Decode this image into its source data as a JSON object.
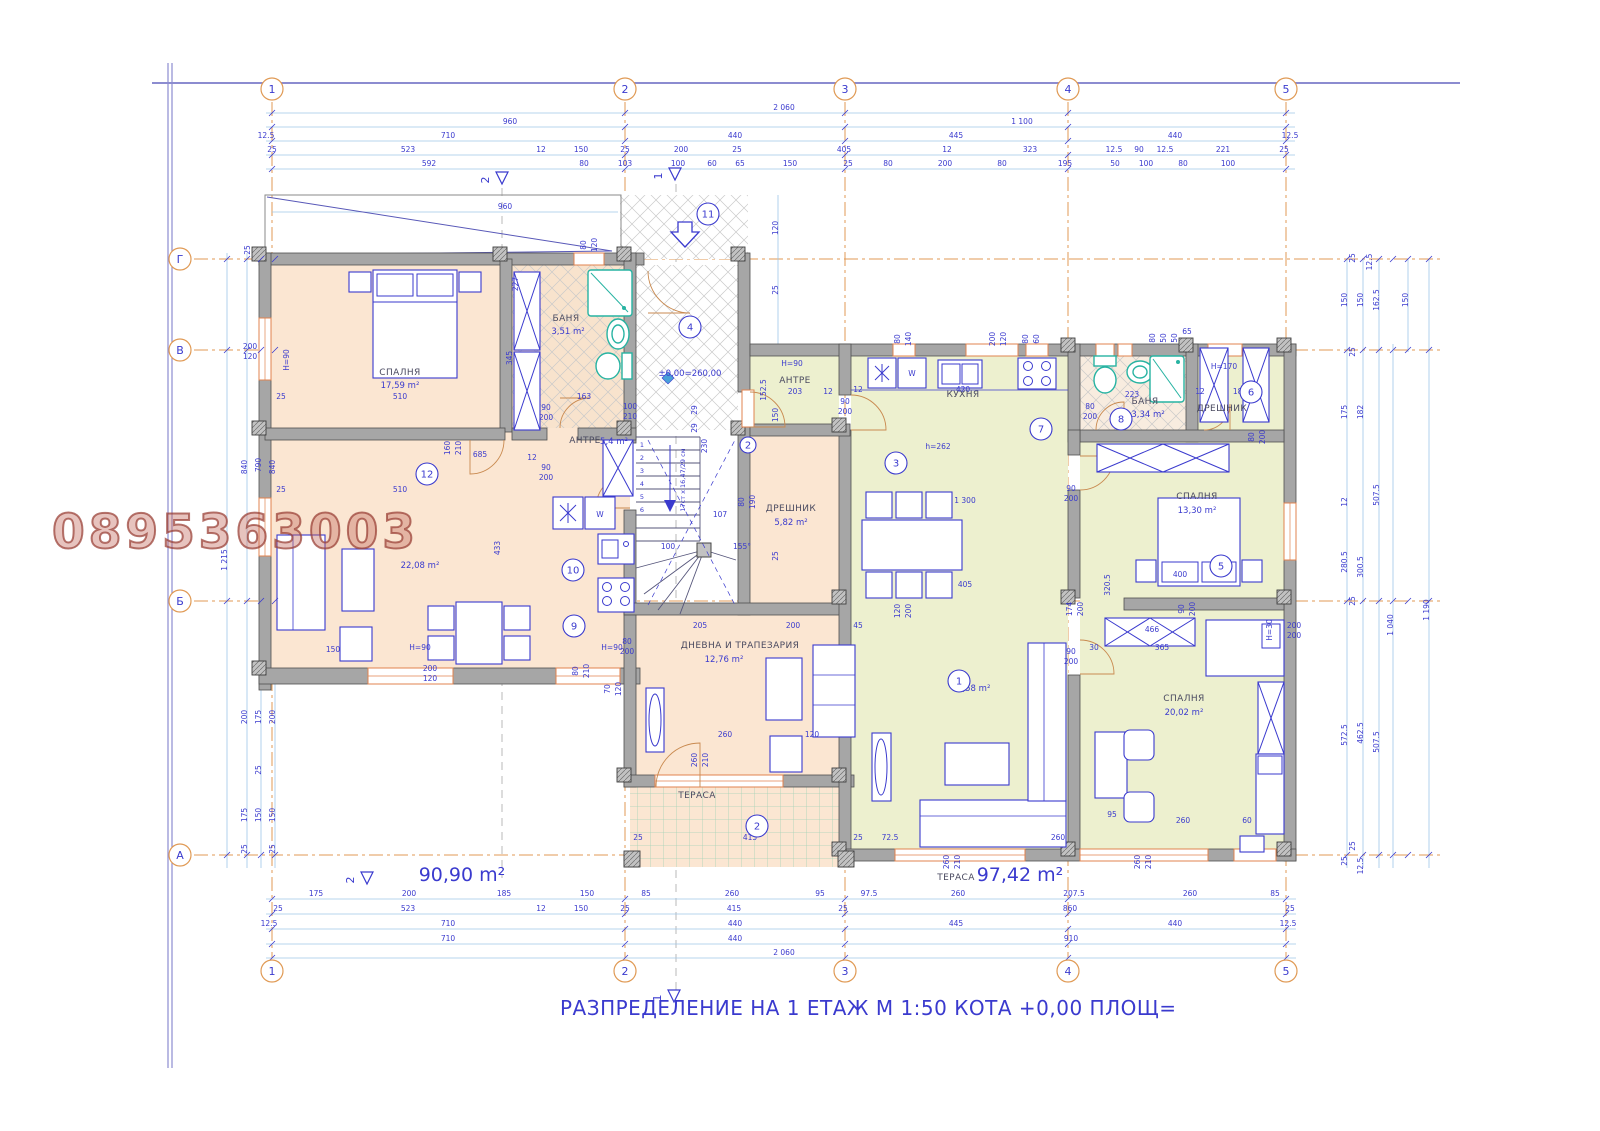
{
  "title": "РАЗПРЕДЕЛЕНИЕ НА 1 ЕТАЖ  М 1:50  КОТА +0,00  ПЛОЩ=",
  "watermark": "0895363003",
  "footer": {
    "left_area": "90,90 m²",
    "right_terrace_label": "ТЕРАСА",
    "right_area": "97,42 m²"
  },
  "level_mark": "±0,00=260,00",
  "stairs_note": "17ст x 16,47/29 см",
  "grid": {
    "cols": [
      "1",
      "2",
      "3",
      "4",
      "5"
    ],
    "col_x": [
      272,
      625,
      845,
      1068,
      1286
    ],
    "rows": [
      "Г",
      "В",
      "Б",
      "А"
    ],
    "row_y": [
      259,
      350,
      601,
      855
    ]
  },
  "rooms": [
    {
      "name": "СПАЛНЯ",
      "area": "17,59 m²"
    },
    {
      "name": "БАНЯ",
      "area": "3,51 m²"
    },
    {
      "name": "АНТРЕ",
      "area": "5,4 m²"
    },
    {
      "name": "",
      "area": "22,08 m²"
    },
    {
      "name": "ДНЕВНА И ТРАПЕЗАРИЯ",
      "area": "12,76 m²"
    },
    {
      "name": "ДРЕШНИК",
      "area": "5,82 m²"
    },
    {
      "name": "ТЕРАСА",
      "area": ""
    },
    {
      "name": "АНТРЕ",
      "area": ""
    },
    {
      "name": "КУХНЯ",
      "area": ""
    },
    {
      "name": "БАНЯ",
      "area": "3,34 m²"
    },
    {
      "name": "ДРЕШНИК",
      "area": ""
    },
    {
      "name": "СПАЛНЯ",
      "area": "13,30 m²"
    },
    {
      "name": "СПАЛНЯ",
      "area": "20,02 m²"
    },
    {
      "name": "",
      "area": "41,58 m²"
    },
    {
      "name": "ТЕРАСА",
      "area": "97,42 m²"
    }
  ],
  "room_tags": [
    {
      "n": "11",
      "x": 708,
      "y": 214
    },
    {
      "n": "4",
      "x": 690,
      "y": 327
    },
    {
      "n": "2",
      "x": 748,
      "y": 445,
      "s": 1
    },
    {
      "n": "12",
      "x": 427,
      "y": 474
    },
    {
      "n": "10",
      "x": 573,
      "y": 570
    },
    {
      "n": "9",
      "x": 574,
      "y": 626
    },
    {
      "n": "3",
      "x": 896,
      "y": 463
    },
    {
      "n": "7",
      "x": 1041,
      "y": 429
    },
    {
      "n": "8",
      "x": 1121,
      "y": 419
    },
    {
      "n": "6",
      "x": 1251,
      "y": 392
    },
    {
      "n": "5",
      "x": 1221,
      "y": 566
    },
    {
      "n": "1",
      "x": 959,
      "y": 681
    },
    {
      "n": "2",
      "x": 757,
      "y": 826
    }
  ],
  "section_markers": [
    {
      "n": "2",
      "x": 502,
      "y": 180
    },
    {
      "n": "1",
      "x": 675,
      "y": 176
    },
    {
      "n": "2",
      "x": 367,
      "y": 880
    },
    {
      "n": "1",
      "x": 674,
      "y": 998
    }
  ],
  "stair_steps": [
    "1",
    "2",
    "3",
    "4",
    "5",
    "6"
  ],
  "colors": {
    "peach": "#fbe6d2",
    "green": "#edf0cf",
    "wall": "#a6a6a6",
    "blue": "#3a3ace",
    "dim_line": "#9fc6e8",
    "axis_orange": "#e09a55",
    "teal": "#27b3a2",
    "watermark": "#a85648"
  },
  "dim_labels": [
    [
      "2 060",
      784,
      110
    ],
    [
      "960",
      510,
      124
    ],
    [
      "1 100",
      1022,
      124
    ],
    [
      "12.5",
      266,
      138
    ],
    [
      "710",
      448,
      138
    ],
    [
      "440",
      735,
      138
    ],
    [
      "445",
      956,
      138
    ],
    [
      "440",
      1175,
      138
    ],
    [
      "12.5",
      1290,
      138
    ],
    [
      "25",
      272,
      152
    ],
    [
      "523",
      408,
      152
    ],
    [
      "12",
      541,
      152
    ],
    [
      "150",
      581,
      152
    ],
    [
      "25",
      625,
      152
    ],
    [
      "200",
      681,
      152
    ],
    [
      "25",
      737,
      152
    ],
    [
      "405",
      844,
      152
    ],
    [
      "12",
      947,
      152
    ],
    [
      "323",
      1030,
      152
    ],
    [
      "12.5",
      1114,
      152
    ],
    [
      "90",
      1139,
      152
    ],
    [
      "12.5",
      1165,
      152
    ],
    [
      "221",
      1223,
      152
    ],
    [
      "25",
      1284,
      152
    ],
    [
      "592",
      429,
      166
    ],
    [
      "80",
      584,
      166
    ],
    [
      "103",
      625,
      166
    ],
    [
      "100",
      678,
      166
    ],
    [
      "60",
      712,
      166
    ],
    [
      "65",
      740,
      166
    ],
    [
      "150",
      790,
      166
    ],
    [
      "25",
      848,
      166
    ],
    [
      "80",
      888,
      166
    ],
    [
      "200",
      945,
      166
    ],
    [
      "80",
      1002,
      166
    ],
    [
      "195",
      1065,
      166
    ],
    [
      "50",
      1115,
      166
    ],
    [
      "100",
      1146,
      166
    ],
    [
      "80",
      1183,
      166
    ],
    [
      "100",
      1228,
      166
    ],
    [
      "175",
      316,
      896
    ],
    [
      "200",
      409,
      896
    ],
    [
      "185",
      504,
      896
    ],
    [
      "150",
      587,
      896
    ],
    [
      "85",
      646,
      896
    ],
    [
      "260",
      732,
      896
    ],
    [
      "95",
      820,
      896
    ],
    [
      "97.5",
      869,
      896
    ],
    [
      "260",
      958,
      896
    ],
    [
      "207.5",
      1074,
      896
    ],
    [
      "260",
      1190,
      896
    ],
    [
      "85",
      1275,
      896
    ],
    [
      "25",
      278,
      911
    ],
    [
      "523",
      408,
      911
    ],
    [
      "12",
      541,
      911
    ],
    [
      "150",
      581,
      911
    ],
    [
      "25",
      625,
      911
    ],
    [
      "415",
      734,
      911
    ],
    [
      "25",
      843,
      911
    ],
    [
      "860",
      1070,
      911
    ],
    [
      "25",
      1290,
      911
    ],
    [
      "12.5",
      269,
      926
    ],
    [
      "710",
      448,
      926
    ],
    [
      "440",
      735,
      926
    ],
    [
      "445",
      956,
      926
    ],
    [
      "440",
      1175,
      926
    ],
    [
      "12.5",
      1288,
      926
    ],
    [
      "710",
      448,
      941
    ],
    [
      "440",
      735,
      941
    ],
    [
      "910",
      1071,
      941
    ],
    [
      "2 060",
      784,
      955
    ],
    [
      "25",
      250,
      250,
      1
    ],
    [
      "840",
      247,
      467,
      1
    ],
    [
      "790",
      261,
      465,
      1
    ],
    [
      "840",
      275,
      467,
      1
    ],
    [
      "1 215",
      227,
      560,
      1
    ],
    [
      "200",
      247,
      717,
      1
    ],
    [
      "175",
      261,
      717,
      1
    ],
    [
      "200",
      275,
      717,
      1
    ],
    [
      "25",
      261,
      770,
      1
    ],
    [
      "175",
      247,
      815,
      1
    ],
    [
      "150",
      261,
      815,
      1
    ],
    [
      "150",
      275,
      815,
      1
    ],
    [
      "25",
      247,
      849,
      1
    ],
    [
      "25",
      275,
      849,
      1
    ],
    [
      "200",
      250,
      349
    ],
    [
      "120",
      250,
      359
    ],
    [
      "H=90",
      289,
      360,
      1
    ],
    [
      "25",
      1355,
      258,
      1
    ],
    [
      "12.5",
      1372,
      262,
      1
    ],
    [
      "150",
      1347,
      300,
      1
    ],
    [
      "150",
      1363,
      300,
      1
    ],
    [
      "162.5",
      1379,
      300,
      1
    ],
    [
      "150",
      1408,
      300,
      1
    ],
    [
      "25",
      1355,
      352,
      1
    ],
    [
      "175",
      1347,
      412,
      1
    ],
    [
      "182",
      1363,
      412,
      1
    ],
    [
      "12",
      1347,
      502,
      1
    ],
    [
      "507.5",
      1379,
      495,
      1
    ],
    [
      "280.5",
      1347,
      562,
      1
    ],
    [
      "300.5",
      1363,
      567,
      1
    ],
    [
      "25",
      1355,
      601,
      1
    ],
    [
      "1 190",
      1429,
      610,
      1
    ],
    [
      "1 040",
      1393,
      625,
      1
    ],
    [
      "572.5",
      1347,
      735,
      1
    ],
    [
      "462.5",
      1363,
      733,
      1
    ],
    [
      "507.5",
      1379,
      742,
      1
    ],
    [
      "25",
      1355,
      846,
      1
    ],
    [
      "25",
      1347,
      861,
      1
    ],
    [
      "12.5",
      1363,
      866,
      1
    ],
    [
      "120",
      778,
      228,
      1
    ],
    [
      "25",
      778,
      290,
      1
    ],
    [
      "150",
      778,
      415,
      1
    ],
    [
      "25",
      778,
      556,
      1
    ],
    [
      "960",
      505,
      209
    ],
    [
      "345",
      512,
      358,
      1
    ],
    [
      "227",
      518,
      284,
      1
    ],
    [
      "510",
      400,
      399
    ],
    [
      "25",
      281,
      399
    ],
    [
      "160",
      450,
      448,
      1
    ],
    [
      "210",
      461,
      448,
      1
    ],
    [
      "685",
      480,
      457
    ],
    [
      "12",
      532,
      460
    ],
    [
      "510",
      400,
      492
    ],
    [
      "25",
      281,
      492
    ],
    [
      "90",
      546,
      410
    ],
    [
      "200",
      546,
      420
    ],
    [
      "90",
      546,
      470
    ],
    [
      "200",
      546,
      480
    ],
    [
      "163",
      584,
      399
    ],
    [
      "100",
      630,
      409
    ],
    [
      "210",
      630,
      419
    ],
    [
      "80",
      586,
      245,
      1
    ],
    [
      "120",
      597,
      245,
      1
    ],
    [
      "433",
      500,
      548,
      1
    ],
    [
      "150",
      333,
      652
    ],
    [
      "H=90",
      420,
      650
    ],
    [
      "200",
      430,
      671
    ],
    [
      "120",
      430,
      681
    ],
    [
      "H=90",
      612,
      650
    ],
    [
      "80",
      578,
      671,
      1
    ],
    [
      "210",
      589,
      671,
      1
    ],
    [
      "70",
      610,
      689,
      1
    ],
    [
      "120",
      621,
      689,
      1
    ],
    [
      "W",
      600,
      517
    ],
    [
      "W",
      912,
      376
    ],
    [
      "230",
      707,
      446,
      1
    ],
    [
      "29",
      697,
      410,
      1
    ],
    [
      "29",
      697,
      428,
      1
    ],
    [
      "100",
      668,
      549
    ],
    [
      "107",
      720,
      517
    ],
    [
      "155°",
      742,
      549
    ],
    [
      "80",
      744,
      502,
      1
    ],
    [
      "190",
      755,
      502,
      1
    ],
    [
      "205",
      700,
      628
    ],
    [
      "200",
      793,
      628
    ],
    [
      "45",
      858,
      628
    ],
    [
      "80",
      627,
      644
    ],
    [
      "200",
      627,
      654
    ],
    [
      "260",
      725,
      737
    ],
    [
      "120",
      812,
      737
    ],
    [
      "260",
      697,
      760,
      1
    ],
    [
      "210",
      708,
      760,
      1
    ],
    [
      "25",
      638,
      840
    ],
    [
      "415",
      750,
      840
    ],
    [
      "25",
      858,
      840
    ],
    [
      "72.5",
      890,
      840
    ],
    [
      "260",
      1058,
      840
    ],
    [
      "H=90",
      792,
      366
    ],
    [
      "203",
      795,
      394
    ],
    [
      "152.5",
      766,
      390,
      1
    ],
    [
      "12",
      828,
      394
    ],
    [
      "90",
      845,
      404
    ],
    [
      "200",
      845,
      414
    ],
    [
      "80",
      900,
      339,
      1
    ],
    [
      "140",
      911,
      339,
      1
    ],
    [
      "200",
      995,
      339,
      1
    ],
    [
      "120",
      1006,
      339,
      1
    ],
    [
      "80",
      1028,
      339,
      1
    ],
    [
      "60",
      1039,
      339,
      1
    ],
    [
      "12",
      858,
      392
    ],
    [
      "420",
      963,
      392
    ],
    [
      "h=262",
      938,
      449
    ],
    [
      "80",
      1090,
      409
    ],
    [
      "200",
      1090,
      419
    ],
    [
      "223",
      1132,
      397
    ],
    [
      "80",
      1155,
      338,
      1
    ],
    [
      "50",
      1166,
      338,
      1
    ],
    [
      "50",
      1177,
      338,
      1
    ],
    [
      "65",
      1187,
      334
    ],
    [
      "12",
      1200,
      394
    ],
    [
      "180",
      1240,
      394
    ],
    [
      "150",
      1254,
      387,
      1
    ],
    [
      "H=170",
      1224,
      369
    ],
    [
      "80",
      1254,
      437,
      1
    ],
    [
      "200",
      1265,
      437,
      1
    ],
    [
      "90",
      1071,
      491
    ],
    [
      "200",
      1071,
      501
    ],
    [
      "1 300",
      965,
      503
    ],
    [
      "405",
      965,
      587
    ],
    [
      "400",
      1180,
      577
    ],
    [
      "320.5",
      1110,
      585,
      1
    ],
    [
      "H=30",
      1272,
      630,
      1
    ],
    [
      "200",
      1294,
      628
    ],
    [
      "200",
      1294,
      638
    ],
    [
      "120",
      900,
      611,
      1
    ],
    [
      "200",
      911,
      611,
      1
    ],
    [
      "174",
      1072,
      609,
      1
    ],
    [
      "200",
      1083,
      609,
      1
    ],
    [
      "90",
      1184,
      609,
      1
    ],
    [
      "200",
      1195,
      609,
      1
    ],
    [
      "466",
      1152,
      632
    ],
    [
      "30",
      1094,
      650
    ],
    [
      "365",
      1162,
      650
    ],
    [
      "90",
      1071,
      654
    ],
    [
      "200",
      1071,
      664
    ],
    [
      "95",
      1112,
      817
    ],
    [
      "260",
      1183,
      823
    ],
    [
      "60",
      1247,
      823
    ],
    [
      "260",
      949,
      862,
      1
    ],
    [
      "210",
      960,
      862,
      1
    ],
    [
      "260",
      1140,
      862,
      1
    ],
    [
      "210",
      1151,
      862,
      1
    ]
  ]
}
